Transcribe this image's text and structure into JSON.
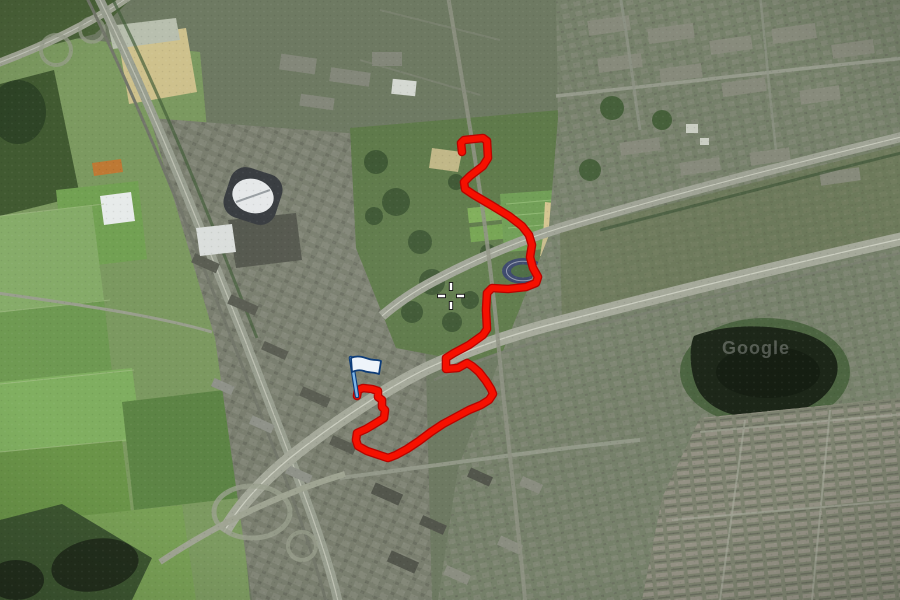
{
  "map": {
    "view_type": "satellite",
    "watermark": "Google",
    "crosshair": {
      "x": 451,
      "y": 296
    },
    "flag_marker": {
      "x": 357,
      "y": 395,
      "pole_color": "#7cb5e8",
      "banner_color": "#eef4fa",
      "outline_color": "#0d3c78"
    },
    "route": {
      "color": "#f61000",
      "casing_color": "#b80400",
      "width": 6,
      "points": [
        [
          462,
          152
        ],
        [
          461,
          143
        ],
        [
          464,
          140
        ],
        [
          483,
          138
        ],
        [
          487,
          141
        ],
        [
          488,
          158
        ],
        [
          483,
          166
        ],
        [
          470,
          176
        ],
        [
          464,
          182
        ],
        [
          465,
          189
        ],
        [
          474,
          195
        ],
        [
          491,
          205
        ],
        [
          509,
          216
        ],
        [
          522,
          226
        ],
        [
          529,
          235
        ],
        [
          532,
          245
        ],
        [
          530,
          257
        ],
        [
          533,
          268
        ],
        [
          538,
          277
        ],
        [
          536,
          283
        ],
        [
          526,
          287
        ],
        [
          508,
          289
        ],
        [
          492,
          288
        ],
        [
          487,
          293
        ],
        [
          486,
          310
        ],
        [
          487,
          329
        ],
        [
          483,
          335
        ],
        [
          469,
          345
        ],
        [
          454,
          353
        ],
        [
          446,
          358
        ],
        [
          446,
          369
        ],
        [
          458,
          368
        ],
        [
          467,
          363
        ],
        [
          472,
          366
        ],
        [
          479,
          372
        ],
        [
          486,
          381
        ],
        [
          491,
          389
        ],
        [
          493,
          394
        ],
        [
          489,
          400
        ],
        [
          481,
          405
        ],
        [
          469,
          410
        ],
        [
          456,
          417
        ],
        [
          443,
          424
        ],
        [
          431,
          432
        ],
        [
          419,
          441
        ],
        [
          407,
          449
        ],
        [
          396,
          455
        ],
        [
          388,
          458
        ],
        [
          379,
          455
        ],
        [
          367,
          451
        ],
        [
          358,
          446
        ],
        [
          356,
          440
        ],
        [
          357,
          433
        ],
        [
          366,
          429
        ],
        [
          376,
          423
        ],
        [
          384,
          418
        ],
        [
          385,
          410
        ],
        [
          382,
          407
        ],
        [
          382,
          400
        ],
        [
          378,
          397
        ],
        [
          378,
          391
        ],
        [
          372,
          389
        ],
        [
          363,
          388
        ],
        [
          358,
          390
        ],
        [
          357,
          396
        ]
      ]
    }
  }
}
